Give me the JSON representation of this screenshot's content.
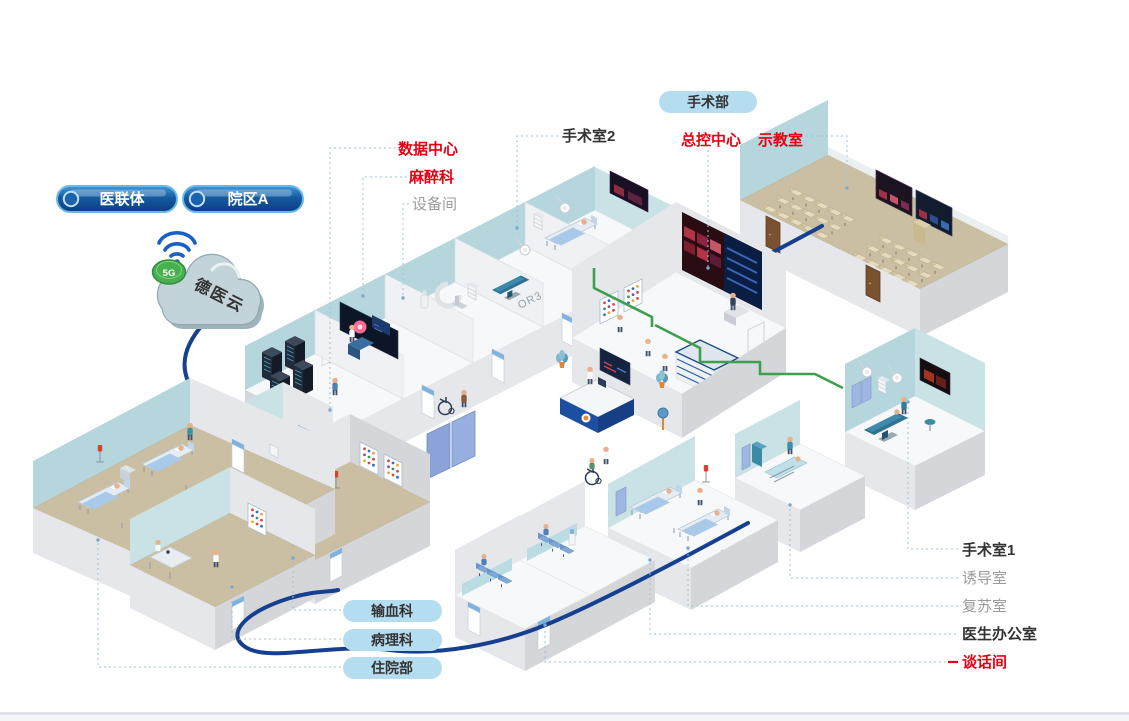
{
  "diagram": {
    "cloud": {
      "label": "德医云",
      "badge_label": "5G"
    },
    "top_pills": [
      {
        "label": "医联体"
      },
      {
        "label": "院区A"
      }
    ],
    "department_pill": {
      "label": "手术部"
    },
    "room_labels": {
      "data_center": {
        "text": "数据中心",
        "style": "red"
      },
      "anesthesiology": {
        "text": "麻醉科",
        "style": "red"
      },
      "equipment_room": {
        "text": "设备间",
        "style": "gray"
      },
      "operating_room_2": {
        "text": "手术室2",
        "style": "dark"
      },
      "master_control": {
        "text": "总控中心",
        "style": "red"
      },
      "demo_classroom": {
        "text": "示教室",
        "style": "red"
      },
      "operating_room_1": {
        "text": "手术室1",
        "style": "dark"
      },
      "induction_room": {
        "text": "诱导室",
        "style": "gray"
      },
      "recovery_room": {
        "text": "复苏室",
        "style": "gray"
      },
      "doctor_office": {
        "text": "医生办公室",
        "style": "dark"
      },
      "talk_room": {
        "text": "谈话间",
        "style": "red"
      }
    },
    "bottom_pills": [
      {
        "label": "输血科"
      },
      {
        "label": "病理科"
      },
      {
        "label": "住院部"
      }
    ],
    "wall_texts": {
      "or2": "OR2",
      "or3": "OR3"
    },
    "colors": {
      "red_label": "#e60012",
      "dark_label": "#333333",
      "gray_label": "#9b9b9b",
      "pill_light_blue": "#b5ddf0",
      "pill_dark_blue": "#0d4c97",
      "backbone_cable": "#16408f",
      "green_cable": "#3f9e4f",
      "connector_dotted": "#9cc0de",
      "wall_teal": "#b4d6dc",
      "floor_tan": "#cabfa2"
    }
  }
}
